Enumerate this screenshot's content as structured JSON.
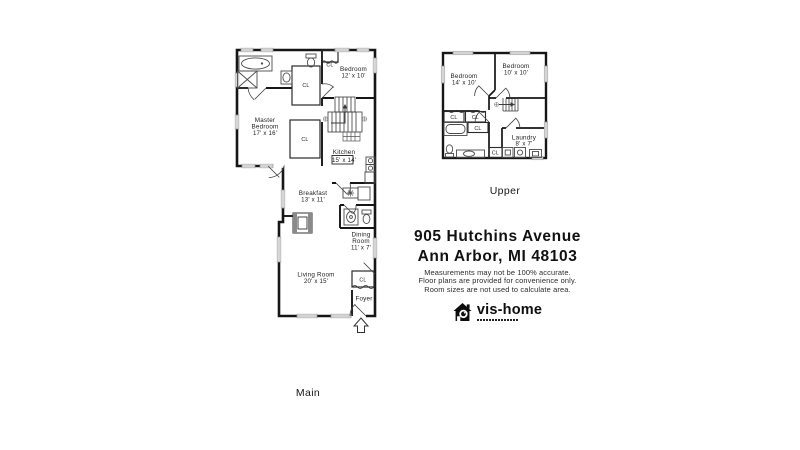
{
  "header": {
    "address_line1": "905 Hutchins Avenue",
    "address_line2": "Ann Arbor, MI 48103"
  },
  "disclaimer": {
    "line1": "Measurements may not be 100% accurate.",
    "line2": "Floor plans are provided for convenience only.",
    "line3": "Room sizes are not used to calculate area."
  },
  "logo": {
    "brand": "vis-home",
    "icon": "house-camera-icon"
  },
  "floors": {
    "main": {
      "label": "Main",
      "rooms": {
        "master_bedroom": {
          "name1": "Master",
          "name2": "Bedroom",
          "dims": "17' x 16'"
        },
        "bedroom": {
          "name1": "Bedroom",
          "dims": "12' x 10'"
        },
        "kitchen": {
          "name1": "Kitchen",
          "dims": "15' x 14'"
        },
        "breakfast": {
          "name1": "Breakfast",
          "dims": "13' x 11'"
        },
        "dining_room": {
          "name1": "Dining",
          "name2": "Room",
          "dims": "11' x 7'"
        },
        "living_room": {
          "name1": "Living Room",
          "dims": "20' x 15'"
        },
        "foyer": {
          "name1": "Foyer"
        },
        "closet_abbr": "CL"
      }
    },
    "upper": {
      "label": "Upper",
      "rooms": {
        "bedroom_left": {
          "name1": "Bedroom",
          "dims": "14' x 10'"
        },
        "bedroom_right": {
          "name1": "Bedroom",
          "dims": "10' x 10'"
        },
        "laundry": {
          "name1": "Laundry",
          "dims": "8' x 7'"
        },
        "closet_abbr": "CL"
      }
    }
  },
  "colors": {
    "wall": "#161616",
    "fixture": "#4a4a4a",
    "window": "#9a9a9a",
    "text": "#1c1c1c"
  }
}
